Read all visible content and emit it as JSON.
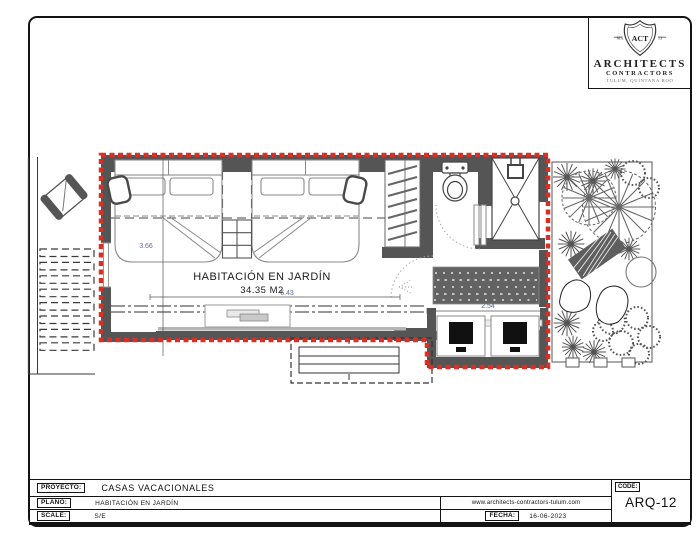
{
  "logo": {
    "shield_left": "MX",
    "shield_center": "ACT",
    "shield_right": "13",
    "firm_name": "ARCHITECTS",
    "firm_subtitle": "CONTRACTORS",
    "firm_location": "TULUM, QUINTANA ROO"
  },
  "plan": {
    "room_label": "HABITACIÓN EN JARDÍN",
    "area_label": "34.35 M2",
    "dims": {
      "width": "6.43",
      "depth": "3.66",
      "vanity": "2.54"
    }
  },
  "titleblock": {
    "project_label": "PROYECTO:",
    "project_value": "CASAS VACACIONALES",
    "plan_label": "PLANO:",
    "plan_value": "HABITACIÓN EN JARDÍN",
    "scale_label": "SCALE:",
    "scale_value": "S/E",
    "website": "www.architects-contractors-tulum.com",
    "date_label": "FECHA:",
    "date_value": "16-06-2023",
    "code_label": "CODE:",
    "code_value": "ARQ-12"
  },
  "colors": {
    "wall": "#555555",
    "outline": "#d93025",
    "dimension": "#5b6b9a"
  }
}
